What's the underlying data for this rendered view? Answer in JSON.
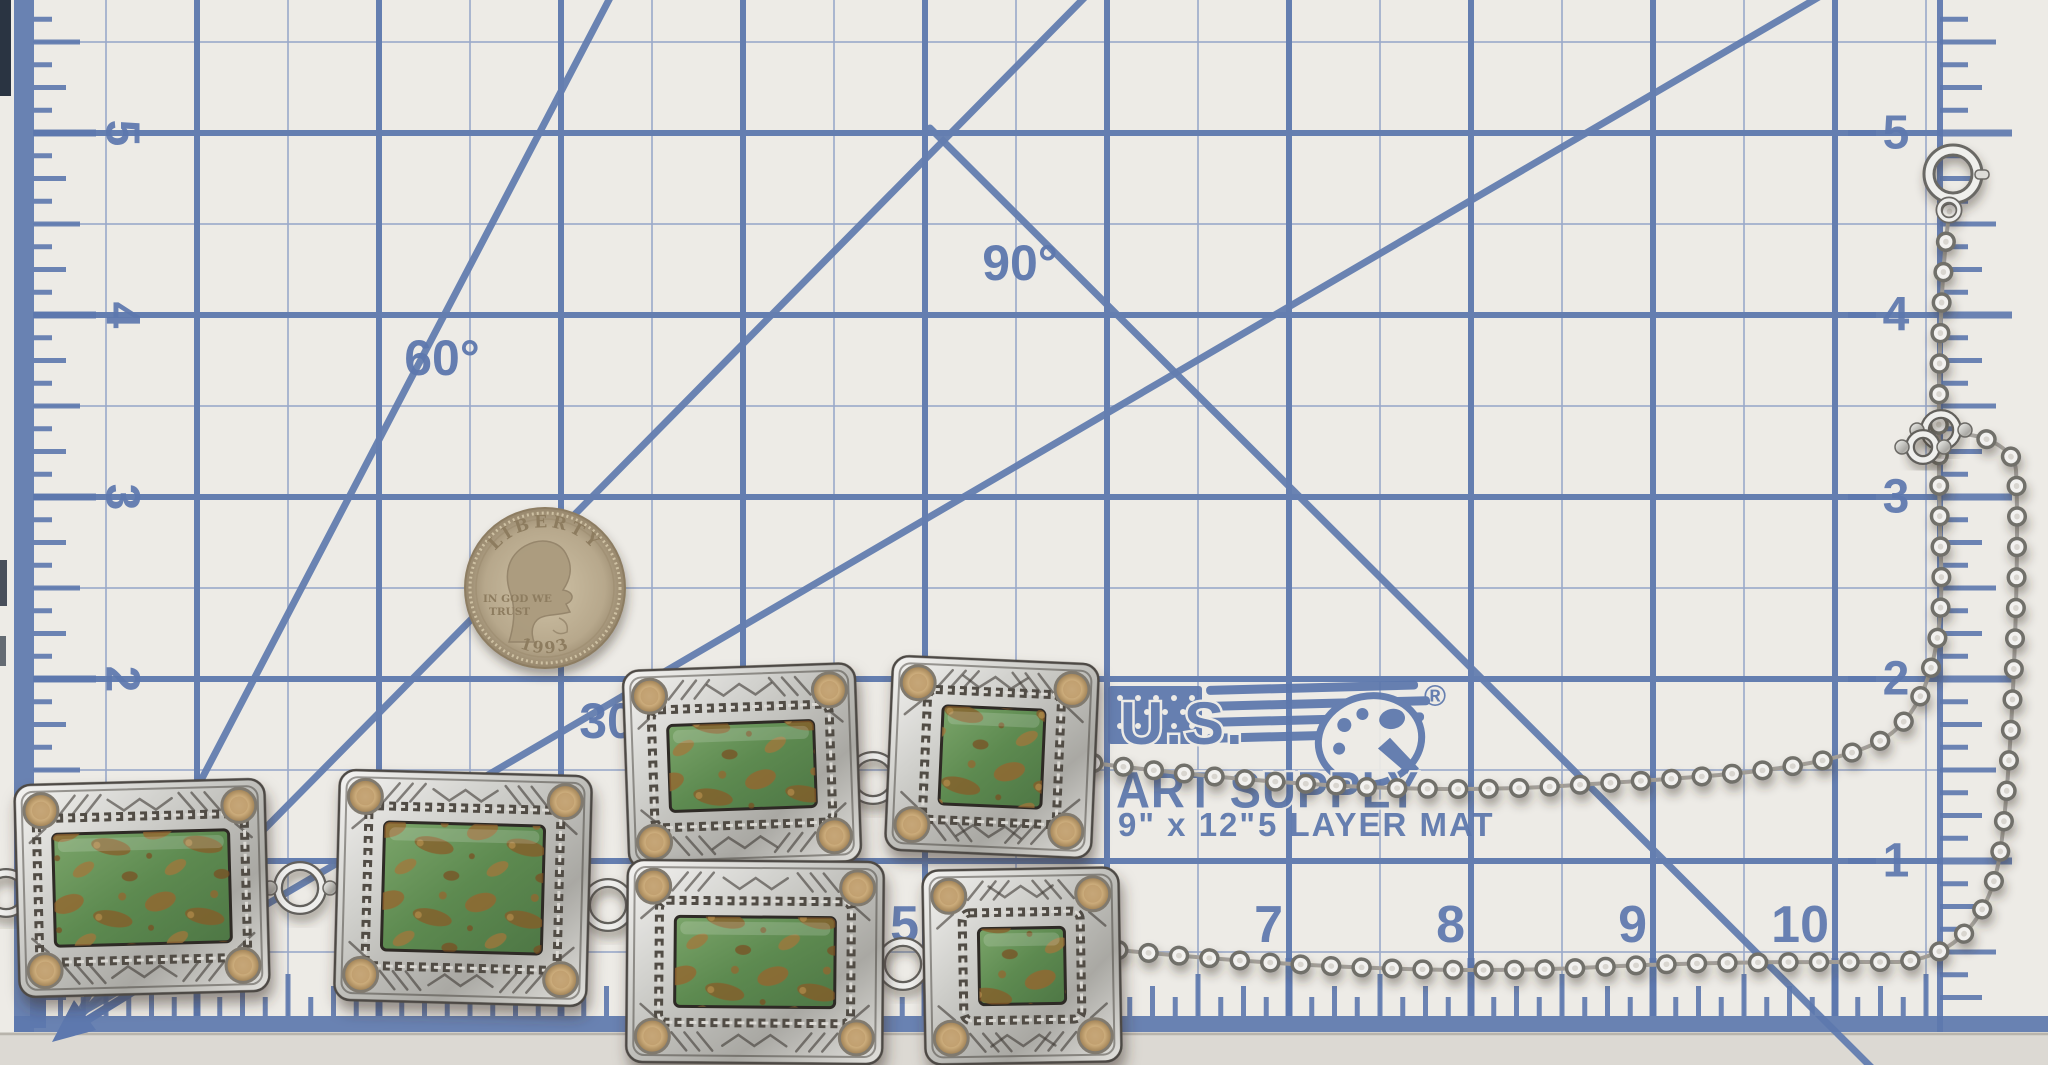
{
  "scene": {
    "description": "Photograph of a sterling silver and green turquoise lariat necklace with six stamped concho plaques and a rolo chain, laid on a blue-grid self-healing cutting mat with a 1993 US quarter shown for scale"
  },
  "mat": {
    "logo": {
      "line1": "U.S.",
      "line2": "ART SUPPLY",
      "registered": "®",
      "size_text": "9\" x 12\"",
      "layers_text": "5 LAYER MAT"
    },
    "unit_label": "inch",
    "angles": {
      "deg60": "60°",
      "deg90": "90°",
      "deg30": "30°"
    },
    "rulers": {
      "left": [
        "5",
        "4",
        "3",
        "2"
      ],
      "right": [
        "5",
        "4",
        "3",
        "2",
        "1"
      ],
      "bottom": [
        "5",
        "6",
        "7",
        "8",
        "9",
        "10"
      ]
    },
    "colors": {
      "background": "#edebe6",
      "grid_major": "#647eb0",
      "grid_fine": "#9aa9ca",
      "text_blue": "#5d78ae",
      "bottom_edge": "#dcd9d3"
    },
    "geometry": {
      "inch_px": 182,
      "origin_x": 197,
      "origin_y": 133,
      "v_major": [
        197,
        379,
        561,
        743,
        925,
        1107,
        1289,
        1471,
        1653,
        1835
      ],
      "h_major": [
        133,
        315,
        497,
        679,
        861
      ],
      "v_fine": [
        106,
        288,
        470,
        652,
        834,
        1016,
        1198,
        1380,
        1562,
        1744,
        1926
      ],
      "h_fine": [
        42,
        224,
        406,
        588,
        770,
        952
      ],
      "grid_right_limit": 1940,
      "grid_bottom_limit": 1016,
      "diagonals": [
        {
          "name": "line-60deg",
          "x1": 82,
          "y1": 1008,
          "x2": 612,
          "y2": -6
        },
        {
          "name": "line-45deg",
          "x1": 84,
          "y1": 1012,
          "x2": 1090,
          "y2": -8
        },
        {
          "name": "line-30deg",
          "x1": 86,
          "y1": 1010,
          "x2": 1824,
          "y2": -6
        },
        {
          "name": "line-90deg-drop",
          "x1": 930,
          "y1": 128,
          "x2": 1872,
          "y2": 1068
        }
      ],
      "baseline_y": 1016,
      "right_ruler_x": 1940
    }
  },
  "coin": {
    "legend": "LIBERTY",
    "motto_line1": "IN GOD WE",
    "motto_line2": "TRUST",
    "year": "1993",
    "cx": 545,
    "cy": 588,
    "radius": 80,
    "color": "#b7a88c"
  },
  "necklace": {
    "silver_color": "#d6d5d1",
    "stone_green": "#5d8a50",
    "matrix_brown": "#96652e",
    "bezel_tan": "#c8a877",
    "plaques": [
      {
        "cx": 142,
        "cy": 888,
        "w": 250,
        "h": 212,
        "rot": -1.5,
        "sw": 176,
        "sh": 112
      },
      {
        "cx": 463,
        "cy": 888,
        "w": 252,
        "h": 230,
        "rot": 1.5,
        "sw": 160,
        "sh": 128
      },
      {
        "cx": 742,
        "cy": 766,
        "w": 232,
        "h": 198,
        "rot": -2,
        "sw": 146,
        "sh": 86
      },
      {
        "cx": 755,
        "cy": 962,
        "w": 256,
        "h": 202,
        "rot": 0.5,
        "sw": 160,
        "sh": 90
      },
      {
        "cx": 992,
        "cy": 757,
        "w": 206,
        "h": 194,
        "rot": 2.5,
        "sw": 102,
        "sh": 98
      },
      {
        "cx": 1022,
        "cy": 966,
        "w": 196,
        "h": 194,
        "rot": -1,
        "sw": 86,
        "sh": 76
      }
    ],
    "rings": [
      {
        "x": 6,
        "y": 893,
        "r": 20
      },
      {
        "x": 300,
        "y": 888,
        "r": 22
      },
      {
        "x": 608,
        "y": 905,
        "r": 22
      },
      {
        "x": 873,
        "y": 778,
        "r": 22
      },
      {
        "x": 903,
        "y": 964,
        "r": 22
      },
      {
        "x": 1941,
        "y": 430,
        "r": 16
      },
      {
        "x": 1923,
        "y": 447,
        "r": 13
      }
    ],
    "chains": {
      "upper": "M1093 763 C1250 783 1420 795 1560 786 C1700 777 1820 772 1878 742 C1930 715 1944 640 1941 560 C1938 480 1936 300 1950 208",
      "lower": "M1118 950 C1280 966 1450 975 1600 967 C1720 961 1830 962 1898 962 C1955 958 1988 920 1999 860 C2012 780 2020 560 2016 470 C2014 450 1990 436 1962 434"
    },
    "clasp": {
      "x": 1953,
      "y": 174,
      "r": 24
    }
  }
}
